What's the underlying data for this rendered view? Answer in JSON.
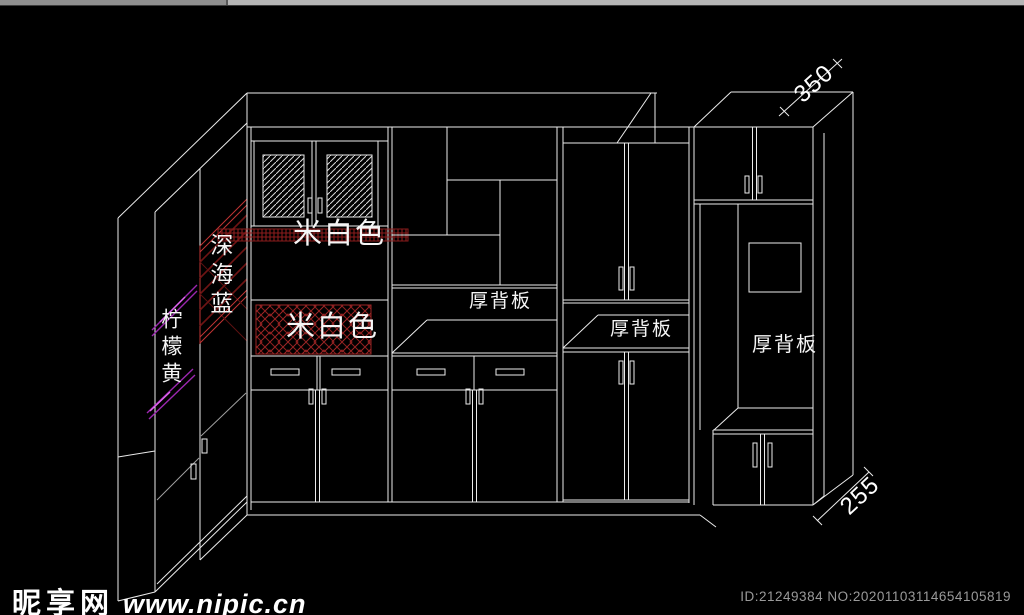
{
  "drawing": {
    "labels": {
      "deep_sea_blue": "深海蓝",
      "lemon_yellow": "柠檬黄",
      "beige_upper": "米白色",
      "beige_lower": "米白色",
      "thick_back_panel_middle": "厚背板",
      "thick_back_panel_right": "厚背板",
      "thick_back_panel_far_right": "厚背板"
    },
    "dimensions": {
      "top_depth": "350",
      "bottom_depth": "255"
    }
  },
  "watermark": {
    "site_name": "昵享网",
    "site_url": "www.nipic.cn"
  },
  "footer": {
    "image_id": "ID:21249384 NO:20201103114654105819"
  },
  "colors": {
    "background": "#000000",
    "cad_line": "#ebebeb",
    "accent_red": "#8b1c1c",
    "accent_red_bright": "#c03434",
    "accent_magenta": "#9c27b0",
    "label_text": "#ffffff",
    "footer_text": "#9a9a9a",
    "scrollbar": "#b6b6b6"
  }
}
